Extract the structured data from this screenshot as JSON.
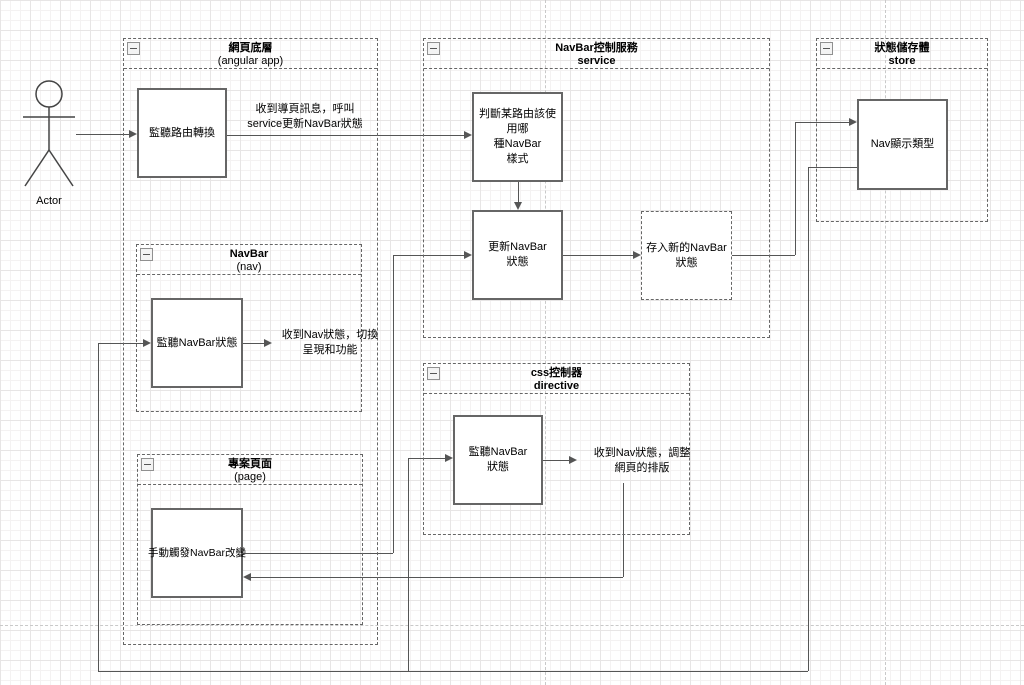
{
  "actor": {
    "label": "Actor"
  },
  "containers": {
    "web": {
      "title": "網頁底層",
      "subtitle": "(angular app)"
    },
    "service": {
      "title": "NavBar控制服務",
      "subtitle": "service"
    },
    "store": {
      "title": "狀態儲存體",
      "subtitle": "store"
    },
    "nav": {
      "title": "NavBar",
      "subtitle": "(nav)"
    },
    "page": {
      "title": "專案頁面",
      "subtitle": "(page)"
    },
    "directive": {
      "title": "css控制器",
      "subtitle": "directive"
    }
  },
  "boxes": {
    "listenRoute": {
      "label": "監聽路由轉換"
    },
    "judgeRoute": {
      "label": "判斷某路由該使用哪\n種NavBar\n樣式"
    },
    "updateState": {
      "label": "更新NavBar\n狀態"
    },
    "saveState": {
      "label": "存入新的NavBar\n狀態"
    },
    "navType": {
      "label": "Nav顯示類型"
    },
    "listenNavState": {
      "label": "監聽NavBar狀態"
    },
    "manualTrigger": {
      "label": "手動觸發NavBar改變"
    },
    "listenNavDirective": {
      "label": "監聽NavBar\n狀態"
    }
  },
  "annotations": {
    "callService": {
      "label": "收到導頁訊息，呼叫\nservice更新NavBar狀態"
    },
    "switchDisplay": {
      "label": "收到Nav狀態，切換\n呈現和功能"
    },
    "adjustLayout": {
      "label": "收到Nav狀態，調整\n網頁的排版"
    }
  },
  "colors": {
    "box_border": "#666666",
    "container_border": "#666666",
    "connector": "#555555",
    "text": "#000000",
    "grid_minor": "#f4f2f2",
    "grid_major": "#e7e5e5",
    "page_divider": "#c9c9c9"
  }
}
